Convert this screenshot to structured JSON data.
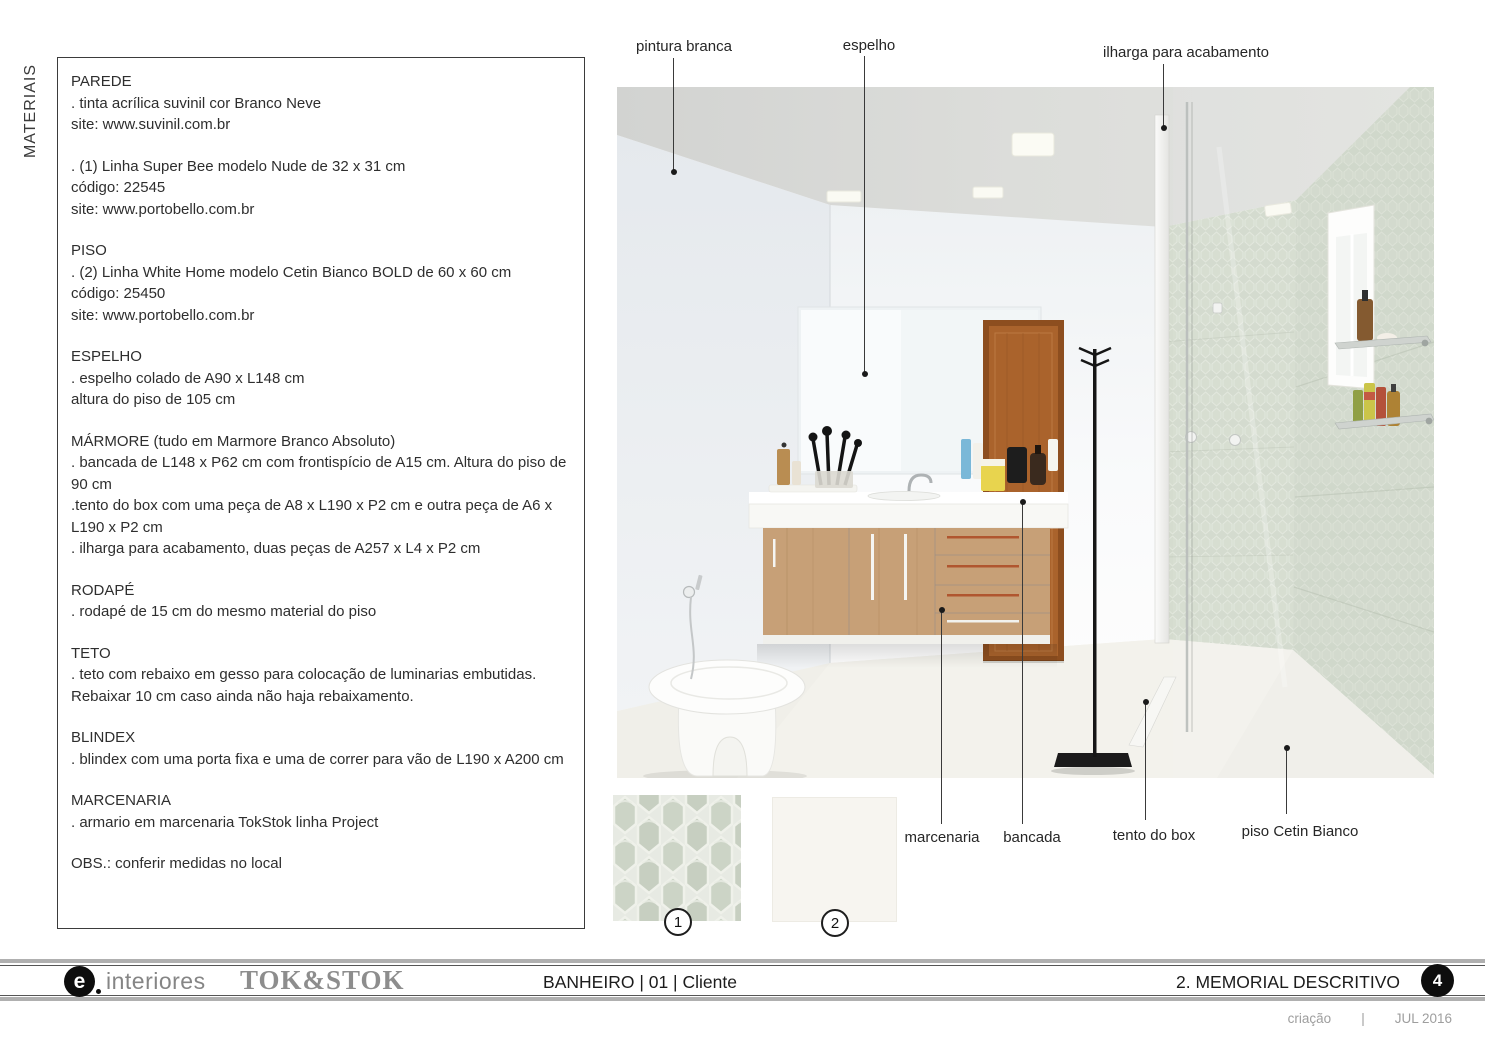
{
  "page": {
    "sidebar_label": "MATERIAIS"
  },
  "materials": {
    "sections": [
      {
        "title": "PAREDE",
        "lines": [
          ". tinta acrílica suvinil cor Branco Neve",
          "site: www.suvinil.com.br"
        ]
      },
      {
        "lines": [
          ". (1) Linha Super Bee modelo Nude  de 32 x 31 cm",
          "código: 22545",
          "site: www.portobello.com.br"
        ]
      },
      {
        "title": "PISO",
        "lines": [
          ". (2) Linha White Home modelo Cetin Bianco BOLD de 60 x 60 cm",
          "código: 25450",
          "site: www.portobello.com.br"
        ]
      },
      {
        "title": "ESPELHO",
        "lines": [
          ". espelho colado de A90 x L148 cm",
          "altura do piso de 105 cm"
        ]
      },
      {
        "title": "MÁRMORE (tudo em Marmore Branco Absoluto)",
        "lines": [
          ". bancada de L148 x P62 cm com frontispício de A15 cm. Altura do piso de 90 cm",
          ".tento do box com uma peça de A8 x L190 x P2 cm e outra peça de A6 x L190 x P2 cm",
          ". ilharga para acabamento, duas peças de A257 x L4 x P2 cm"
        ]
      },
      {
        "title": "RODAPÉ",
        "lines": [
          ". rodapé de 15 cm do mesmo material do piso"
        ]
      },
      {
        "title": "TETO",
        "lines": [
          ". teto com rebaixo em gesso para colocação de luminarias embutidas. Rebaixar 10 cm caso ainda não haja rebaixamento."
        ]
      },
      {
        "title": "BLINDEX",
        "lines": [
          ". blindex com uma porta fixa e uma de correr para vão de L190 x A200 cm"
        ]
      },
      {
        "title": "MARCENARIA",
        "lines": [
          ". armario em marcenaria TokStok linha Project"
        ]
      },
      {
        "lines": [
          "OBS.: conferir medidas no local"
        ]
      }
    ]
  },
  "callouts": {
    "pintura_branca": "pintura branca",
    "espelho": "espelho",
    "ilharga": "ilharga para acabamento",
    "marcenaria": "marcenaria",
    "bancada": "bancada",
    "tento_do_box": "tento do box",
    "piso": "piso Cetin Bianco"
  },
  "swatches": [
    {
      "number": "1",
      "color": "#ccd3c6"
    },
    {
      "number": "2",
      "color": "#f7f5f0"
    }
  ],
  "footer": {
    "brand_e": "e",
    "brand_e_suffix": "interiores",
    "brand_tokstok": "TOK&STOK",
    "project": "BANHEIRO | 01 | Cliente",
    "section_title": "2. MEMORIAL DESCRITIVO",
    "page_number": "4",
    "credits": {
      "label": "criação",
      "separator": "|",
      "date": "JUL 2016"
    }
  },
  "colors": {
    "text": "#2b2b2b",
    "rule_gray": "#b0b0b0",
    "logo_gray": "#8d8d8d",
    "tile_green": "#cdd5c8",
    "door_wood": "#a9632c",
    "cabinet_wood": "#c7a077",
    "floor": "#f0efe9",
    "ceiling": "#dadbd9"
  }
}
